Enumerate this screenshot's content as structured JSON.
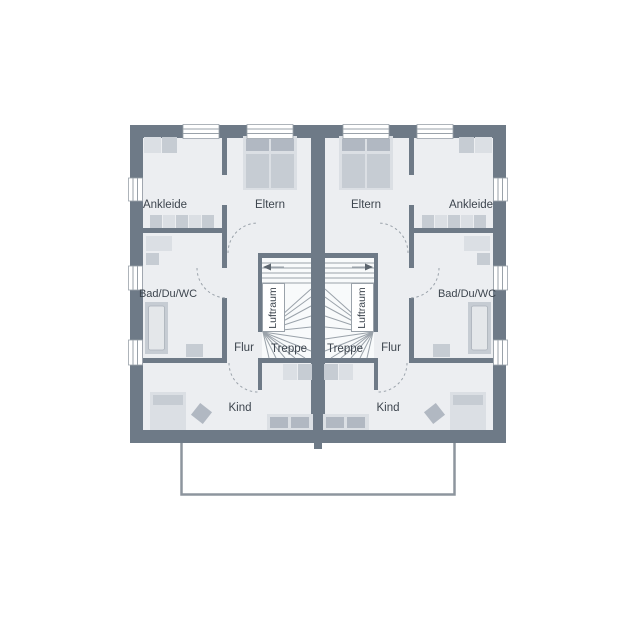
{
  "plan": {
    "kind": "residential-floor-plan",
    "units": 2,
    "mirrored": true
  },
  "units": [
    {
      "side": "left",
      "rooms": [
        {
          "id": "ankleide",
          "label": "Ankleide"
        },
        {
          "id": "eltern",
          "label": "Eltern"
        },
        {
          "id": "bad",
          "label": "Bad/Du/WC"
        },
        {
          "id": "flur",
          "label": "Flur"
        },
        {
          "id": "treppe",
          "label": "Treppe"
        },
        {
          "id": "luftraum",
          "label": "Luftraum"
        },
        {
          "id": "kind",
          "label": "Kind"
        }
      ]
    },
    {
      "side": "right",
      "rooms": [
        {
          "id": "ankleide",
          "label": "Ankleide"
        },
        {
          "id": "eltern",
          "label": "Eltern"
        },
        {
          "id": "bad",
          "label": "Bad/Du/WC"
        },
        {
          "id": "flur",
          "label": "Flur"
        },
        {
          "id": "treppe",
          "label": "Treppe"
        },
        {
          "id": "luftraum",
          "label": "Luftraum"
        },
        {
          "id": "kind",
          "label": "Kind"
        }
      ]
    }
  ],
  "colors": {
    "wall": "#6e7a87",
    "floor": "#eceef1",
    "stairfloor": "#f8fafb",
    "furniture1": "#dbdfe4",
    "furniture2": "#c6ccd3",
    "furniture3": "#b1b8c2",
    "line": "#9aa2aa",
    "text": "#3d454e",
    "outline": "#8d959e",
    "background": "#ffffff"
  }
}
